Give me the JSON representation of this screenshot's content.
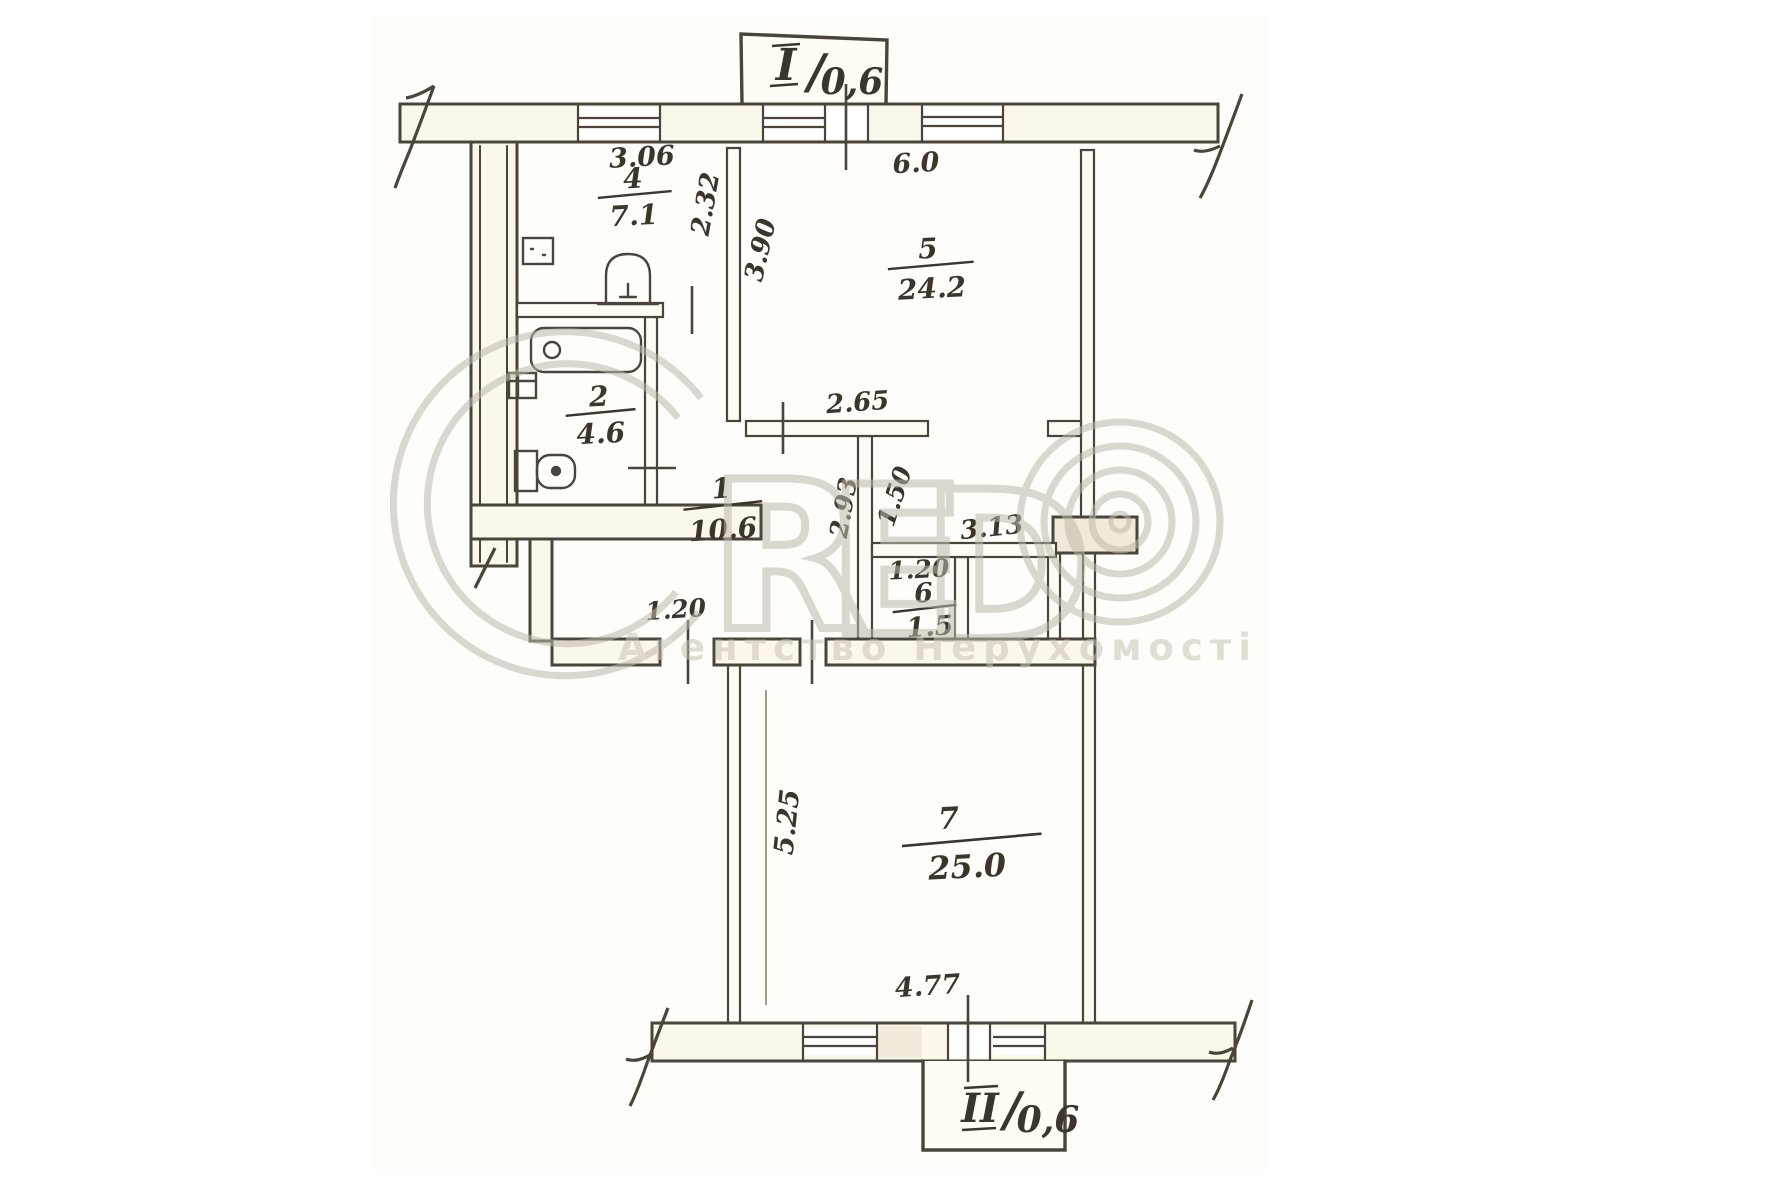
{
  "plan": {
    "balcony_top": {
      "numeral": "I",
      "separator": "/",
      "area": "0,6"
    },
    "balcony_bottom": {
      "numeral": "II",
      "separator": "/",
      "area": "0,6"
    },
    "rooms": {
      "kitchen": {
        "number": "4",
        "area": "7.1"
      },
      "bathroom": {
        "number": "2",
        "area": "4.6"
      },
      "living": {
        "number": "5",
        "area": "24.2"
      },
      "hallway": {
        "number": "1",
        "area": "10.6"
      },
      "closet": {
        "number": "6",
        "area": "1.5"
      },
      "bedroom": {
        "number": "7",
        "area": "25.0"
      }
    },
    "dimensions": {
      "kitchen_width": "3.06",
      "living_width": "6.0",
      "kitchen_depth": "2.32",
      "living_depth": "3.90",
      "hallway_top_width": "2.65",
      "living_lower_depth": "1.50",
      "hallway_depth": "2.93",
      "living_lower_width": "3.13",
      "closet_width": "1.20",
      "entry_width": "1.20",
      "bedroom_depth": "5.25",
      "bedroom_width": "4.77"
    }
  },
  "watermark": {
    "brand": "CRED",
    "brand_letters": {
      "r": "R",
      "e": "E",
      "d": "D"
    },
    "copyright_symbol": "©",
    "subtitle": "Агентство Нерухомості"
  },
  "colors": {
    "ink": "#4a443a",
    "label_ink": "#3b352b",
    "paper": "#ffffff",
    "wall_fill": "#fbf7eb",
    "watermark": "#beb9ab"
  }
}
